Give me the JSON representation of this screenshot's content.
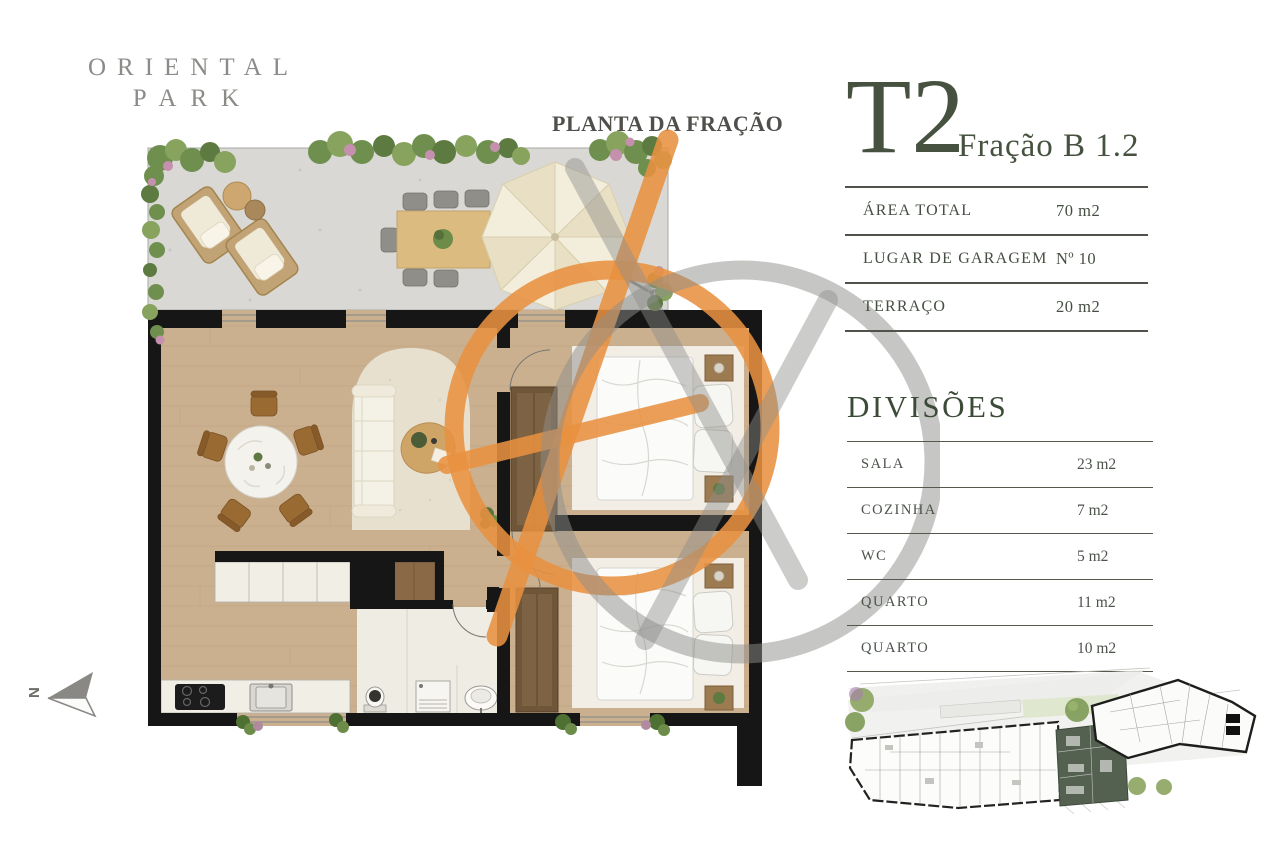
{
  "brand": {
    "line1": "ORIENTAL",
    "line2": "PARK"
  },
  "plan": {
    "title": "PLANTA DA FRAÇÃO",
    "north_label": "N"
  },
  "unit": {
    "type": "T2",
    "fraction_label": "Fração B 1.2"
  },
  "specs": {
    "rows": [
      {
        "label": "ÁREA TOTAL",
        "value": "70 m2"
      },
      {
        "label": "LUGAR DE GARAGEM",
        "value": "Nº 10"
      },
      {
        "label": "TERRAÇO",
        "value": "20 m2"
      }
    ]
  },
  "divisions": {
    "heading": "DIVISÕES",
    "rows": [
      {
        "label": "SALA",
        "value": "23 m2"
      },
      {
        "label": "COZINHA",
        "value": "7 m2"
      },
      {
        "label": "WC",
        "value": "5 m2"
      },
      {
        "label": "QUARTO",
        "value": "11 m2"
      },
      {
        "label": "QUARTO",
        "value": "10 m2"
      }
    ]
  },
  "colors": {
    "accent_green": "#46523f",
    "keyplan_highlight": "#546050",
    "watermark_orange": "#e89140",
    "watermark_gray": "#8e8e8c",
    "wall_black": "#161616",
    "wood_floor": "#cab08f",
    "terrace_gray": "#d9d8d4"
  },
  "icons": {
    "north": "north-arrow-icon",
    "watermark": "brand-watermark-icon",
    "parasol": "parasol-icon"
  }
}
